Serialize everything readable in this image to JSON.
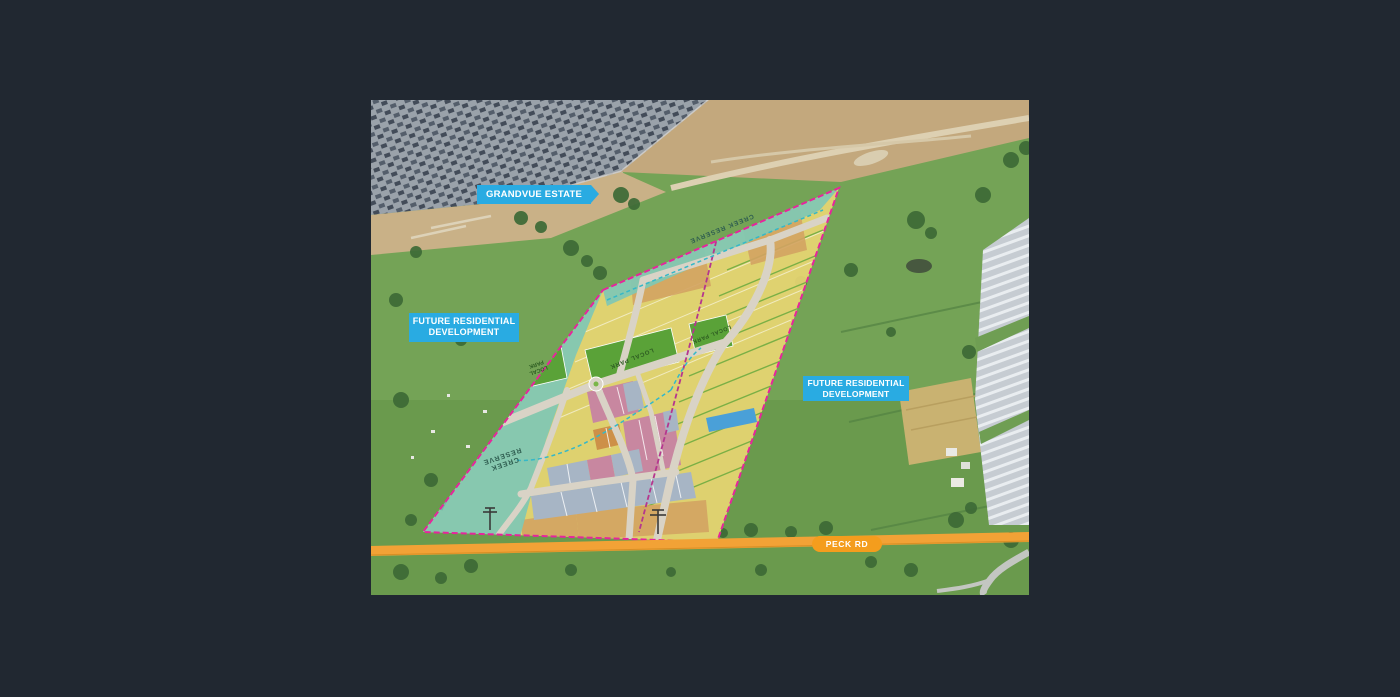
{
  "image": {
    "description": "Aerial masterplan photo of a residential estate",
    "callouts": [
      {
        "id": "grandvue",
        "label": "GRANDVUE ESTATE",
        "color": "#29abe2"
      },
      {
        "id": "future-left",
        "label": "FUTURE RESIDENTIAL DEVELOPMENT",
        "color": "#29abe2"
      },
      {
        "id": "future-right",
        "label": "FUTURE RESIDENTIAL DEVELOPMENT",
        "color": "#29abe2"
      },
      {
        "id": "peck-rd",
        "label": "PECK RD",
        "color": "#f49d1d"
      }
    ],
    "map_labels": {
      "creek_reserve_top": "CREEK RESERVE",
      "creek_reserve_left_line1": "CREEK",
      "creek_reserve_left_line2": "RESERVE",
      "local_park_left_line1": "LOCAL",
      "local_park_left_line2": "PARK",
      "local_park_right": "LOCAL PARK",
      "local_park_right2": "LOCAL PARK"
    },
    "plan_colors": {
      "boundary_magenta": "#e6259c",
      "creek_reserve_teal": "#82c7b2",
      "residential_yellow": "#e7d572",
      "residential_tan": "#d3a362",
      "medium_density_pink": "#c887a0",
      "larger_lot_bluegray": "#a7b5c5",
      "park_green": "#5aa238",
      "water_blue": "#4aa0d8",
      "road_beige": "#d9d3c6",
      "peck_road_orange": "#f2a236",
      "callout_blue": "#29abe2"
    }
  }
}
